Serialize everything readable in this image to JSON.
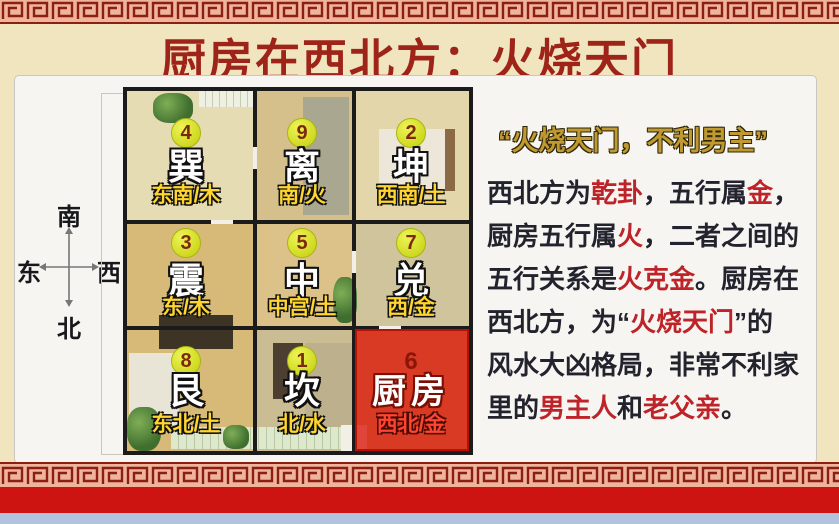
{
  "title": "厨房在西北方：火烧天门",
  "compass": {
    "south": "南",
    "north": "北",
    "east": "东",
    "west": "西"
  },
  "floorplan": {
    "cells": [
      {
        "num": "4",
        "trigram": "巽",
        "direction": "东南/木",
        "row": 0,
        "col": 0,
        "highlight": false
      },
      {
        "num": "9",
        "trigram": "离",
        "direction": "南/火",
        "row": 0,
        "col": 1,
        "highlight": false
      },
      {
        "num": "2",
        "trigram": "坤",
        "direction": "西南/土",
        "row": 0,
        "col": 2,
        "highlight": false
      },
      {
        "num": "3",
        "trigram": "震",
        "direction": "东/木",
        "row": 1,
        "col": 0,
        "highlight": false
      },
      {
        "num": "5",
        "trigram": "中",
        "direction": "中宫/土",
        "row": 1,
        "col": 1,
        "highlight": false
      },
      {
        "num": "7",
        "trigram": "兑",
        "direction": "西/金",
        "row": 1,
        "col": 2,
        "highlight": false
      },
      {
        "num": "8",
        "trigram": "艮",
        "direction": "东北/土",
        "row": 2,
        "col": 0,
        "highlight": false
      },
      {
        "num": "1",
        "trigram": "坎",
        "direction": "北/水",
        "row": 2,
        "col": 1,
        "highlight": false
      },
      {
        "num": "6",
        "trigram": "厨房",
        "direction": "西北/金",
        "row": 2,
        "col": 2,
        "highlight": true
      }
    ]
  },
  "sidebar": {
    "heading": "“火烧天门，不利男主”",
    "lines": [
      {
        "segments": [
          {
            "t": "西北方为",
            "red": false
          },
          {
            "t": "乾卦",
            "red": true
          },
          {
            "t": "，五行属",
            "red": false
          },
          {
            "t": "金",
            "red": true
          },
          {
            "t": "，",
            "red": false
          }
        ]
      },
      {
        "segments": [
          {
            "t": "厨房五行属",
            "red": false
          },
          {
            "t": "火",
            "red": true
          },
          {
            "t": "，二者之间的",
            "red": false
          }
        ]
      },
      {
        "segments": [
          {
            "t": "五行关系是",
            "red": false
          },
          {
            "t": "火克金",
            "red": true
          },
          {
            "t": "。厨房在",
            "red": false
          }
        ]
      },
      {
        "segments": [
          {
            "t": "西北方，为“",
            "red": false
          },
          {
            "t": "火烧天门",
            "red": true
          },
          {
            "t": "”的",
            "red": false
          }
        ]
      },
      {
        "segments": [
          {
            "t": "风水大凶格局，非常不利家",
            "red": false
          }
        ]
      },
      {
        "segments": [
          {
            "t": "里的",
            "red": false
          },
          {
            "t": "男主人",
            "red": true
          },
          {
            "t": "和",
            "red": false
          },
          {
            "t": "老父亲",
            "red": true
          },
          {
            "t": "。",
            "red": false
          }
        ]
      }
    ]
  },
  "colors": {
    "title": "#9e2318",
    "heading": "#c09a30",
    "body": "#23232e",
    "emphasis": "#bd2328",
    "badge": "#d8e030",
    "direction_label": "#ffd52e",
    "kitchen_highlight": "#d91a0d",
    "border_pattern": "#8c1f12",
    "border_band_bg": "#eeb49c",
    "red_band": "#ce1410",
    "bottom_strip": "#b2c3de"
  }
}
